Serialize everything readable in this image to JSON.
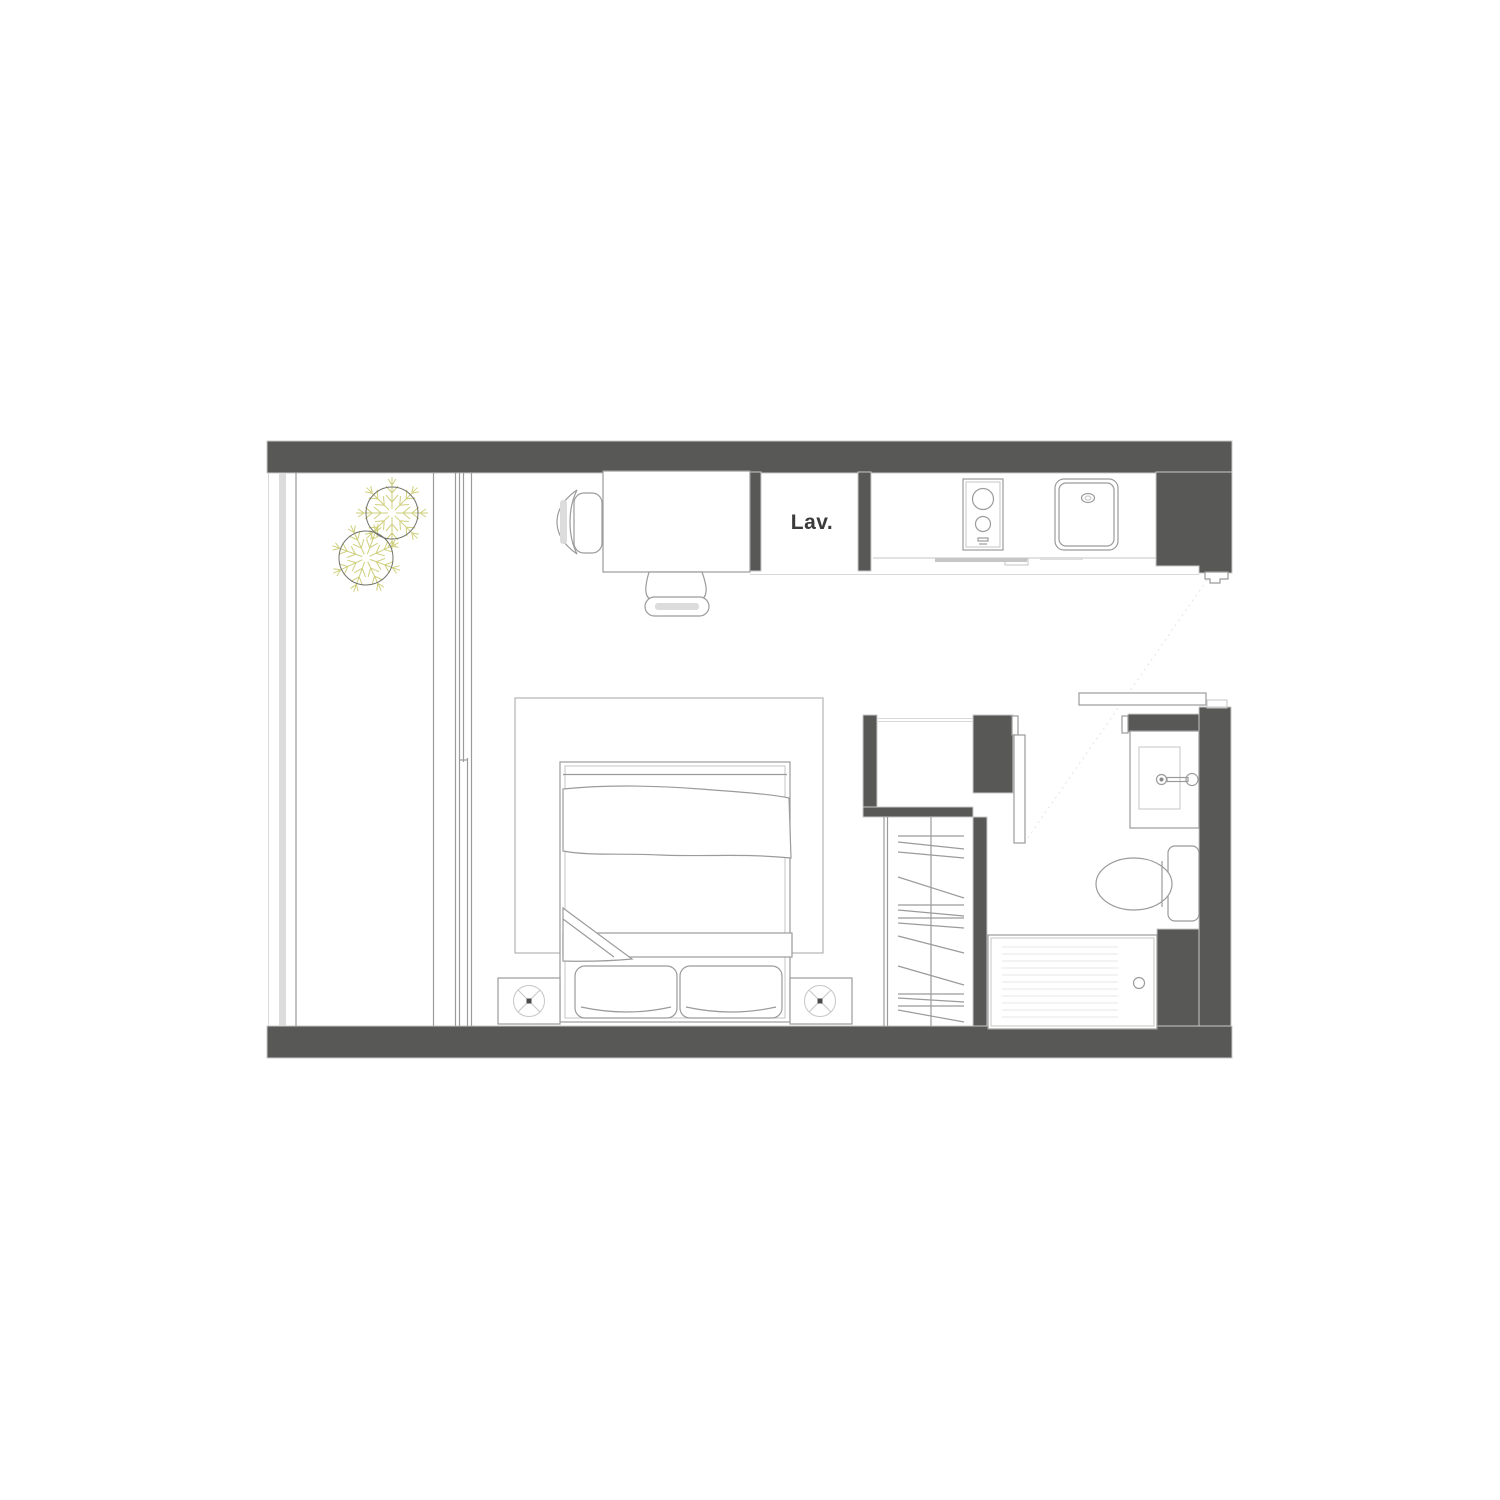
{
  "floorplan": {
    "labels": {
      "laundry": "Lav."
    },
    "colors": {
      "wall": "#585856",
      "wall_outline": "#c9c9c9",
      "furniture": "#9b9b9b",
      "furniture_light": "#c6c6c6",
      "light_line": "#d9d9d9",
      "glass": "#dcdcdc",
      "shade": "#dcdcdc",
      "texture": "#efefef",
      "plant": "#cfcf7d",
      "plant_circle": "#72726c",
      "label": "#3b3b3b"
    },
    "elements": [
      "balcony-railing",
      "potted-plants",
      "sliding-glass-door",
      "desk",
      "desk-chairs",
      "laundry-closet",
      "kitchen-counter",
      "two-burner-cooktop",
      "kitchen-sink",
      "entry-closet",
      "wardrobe-with-hangers",
      "bathroom-sliding-door",
      "bathroom-shelf",
      "vanity-sink",
      "toilet",
      "shower-with-drain",
      "rug",
      "double-bed",
      "pillows",
      "nightstands",
      "table-lamps"
    ]
  }
}
